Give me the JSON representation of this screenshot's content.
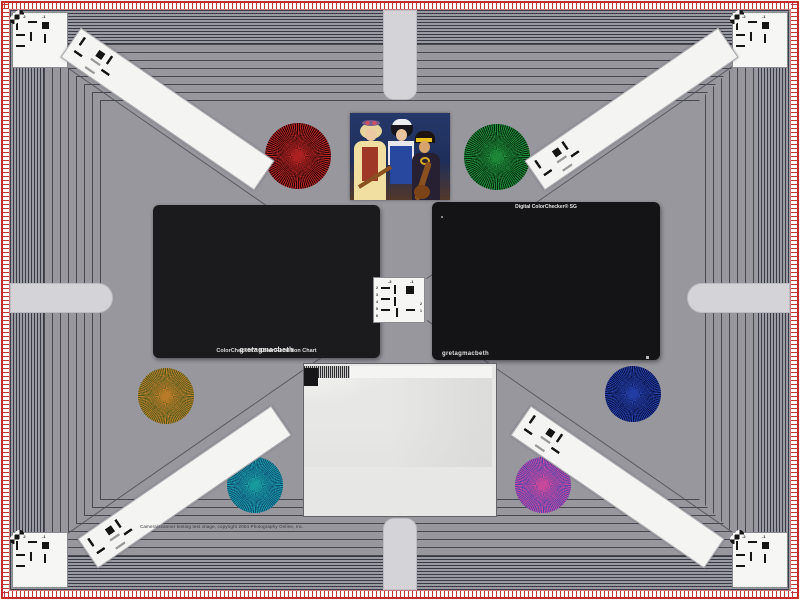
{
  "meta": {
    "background_gray": "#97979d",
    "frame_red": "#c62b2b",
    "tongue_gray": "#d4d4d8",
    "line_color": "#50505a"
  },
  "caption": {
    "text": "Camera/scanner testing test image, copyright 2004 Photography Online, Inc."
  },
  "colorchecker": {
    "brand": "gretagmacbeth",
    "name": "ColorChecker™ Color Rendition Chart",
    "patches": [
      "#7a4b39",
      "#dba08f",
      "#5879a8",
      "#5a6b34",
      "#8f8fc8",
      "#66cfc0",
      "#e1872c",
      "#4b64c0",
      "#da5f72",
      "#6a3d84",
      "#a8bf38",
      "#eab626",
      "#3142bb",
      "#2f9647",
      "#cf3a40",
      "#eecb1e",
      "#dd6ec0",
      "#1a9ed0",
      "#f2f2f0",
      "#d5d5d3",
      "#b2b2b0",
      "#8a8a88",
      "#606060",
      "#2c2c2c"
    ]
  },
  "sg": {
    "title": "Digital ColorChecker® SG",
    "brand": "gretagmacbeth",
    "cols": 14,
    "rows": 10,
    "patches": [
      "#f0f0ee",
      "#9a9a9a",
      "#1e1e1e",
      "#f0f0ee",
      "#9a9a9a",
      "#1e1e1e",
      "#f0f0ee",
      "#9a9a9a",
      "#1e1e1e",
      "#f0f0ee",
      "#9a9a9a",
      "#1e1e1e",
      "#9a9a9a",
      "#f0f0ee",
      "#1e1e1e",
      "#c22858",
      "#4a2470",
      "#b8d0e8",
      "#7a4830",
      "#e89078",
      "#a0c4e0",
      "#3a58a8",
      "#3a4a1a",
      "#6a58b8",
      "#90d8d0",
      "#e8c0a0",
      "#d02030",
      "#e04878",
      "#9a9a9a",
      "#e87828",
      "#207888",
      "#b0b8c0",
      "#4a7828",
      "#3858c0",
      "#e08828",
      "#283878",
      "#784828",
      "#e8d020",
      "#a8c8e8",
      "#906030",
      "#d05868",
      "#1e1e1e",
      "#f0f0ee",
      "#b038c0",
      "#3858d0",
      "#98a8b8",
      "#283890",
      "#28a048",
      "#c03028",
      "#e87820",
      "#e8d020",
      "#e038a0",
      "#18a8d8",
      "#d8c8b8",
      "#e85878",
      "#9a9a9a",
      "#1e1e1e",
      "#48c8c0",
      "#c8d8e8",
      "#f0f0ee",
      "#303030",
      "#282828",
      "#202020",
      "#181818",
      "#303030",
      "#a8d0e8",
      "#687888",
      "#b0b0b0",
      "#d88898",
      "#f0f0ee",
      "#9a9a9a",
      "#18a098",
      "#a0e8d8",
      "#c8e8c0",
      "#282828",
      "#484848",
      "#f0f0ee",
      "#1e1e1e",
      "#e0a020",
      "#f0f0ee",
      "#b8b8b8",
      "#d0d0d0",
      "#e8e020",
      "#1e1e1e",
      "#f0f0ee",
      "#4878c8",
      "#78b8e8",
      "#f0c8a0",
      "#e8a078",
      "#f0b890",
      "#d8a880",
      "#e8b088",
      "#d89878",
      "#909090",
      "#e8c8a8",
      "#e8d838",
      "#f0e020",
      "#9a9a9a",
      "#1e1e1e",
      "#283048",
      "#8858b0",
      "#f0c0a8",
      "#f0a8b0",
      "#e89078",
      "#f0c098",
      "#c89868",
      "#e8b890",
      "#906040",
      "#988028",
      "#b8c828",
      "#403818",
      "#f0f0ee",
      "#9a9a9a",
      "#70c888",
      "#18a078",
      "#086858",
      "#30c8b0",
      "#28a038",
      "#20c030",
      "#186828",
      "#e88828",
      "#909828",
      "#30b818",
      "#784818",
      "#302808",
      "#1e1e1e",
      "#f0f0ee",
      "#9a9a9a",
      "#1e1e1e",
      "#9a9a9a",
      "#f0f0ee",
      "#9a9a9a",
      "#1e1e1e",
      "#f0f0ee",
      "#9a9a9a",
      "#1e1e1e",
      "#f0f0ee",
      "#9a9a9a",
      "#1e1e1e",
      "#f0f0ee"
    ]
  },
  "stars": {
    "red": {
      "colors": [
        "#b42222",
        "#2a0a0a"
      ]
    },
    "green": {
      "colors": [
        "#1f8c3a",
        "#062a10"
      ]
    },
    "orange": {
      "colors": [
        "#c07c28",
        "#4a5a20"
      ]
    },
    "blue": {
      "colors": [
        "#2440aa",
        "#0a1040"
      ]
    },
    "teal": {
      "colors": [
        "#18a0a0",
        "#104878"
      ]
    },
    "magenta": {
      "colors": [
        "#d04898",
        "#4848b0"
      ]
    }
  },
  "usaf": {
    "labels_top": [
      "-2",
      "-1"
    ],
    "labels_left": [
      "2",
      "3",
      "4",
      "5",
      "6"
    ],
    "labels_right": [
      "2",
      "1"
    ]
  },
  "sweep": {
    "bar_widths": [
      12,
      12,
      10,
      9,
      8,
      7,
      6,
      5,
      4,
      4,
      3,
      3,
      2,
      2,
      2,
      2,
      1,
      1,
      1,
      1,
      1,
      1,
      1
    ],
    "bar_colors": [
      "#f4f4f2",
      "#161618"
    ],
    "periods": [
      18,
      12,
      8,
      5,
      3
    ],
    "wedge_steps": [
      "#f4f4f2",
      "#ececea",
      "#e4e4e2",
      "#dcdcda",
      "#d4d4d2",
      "#cccccb",
      "#c4c4c2",
      "#bcbcba",
      "#b4b4b2",
      "#acacaa",
      "#a4a4a2",
      "#9a9a98",
      "#909090",
      "#868684",
      "#7c7c7a",
      "#727270",
      "#686866",
      "#5e5e5c",
      "#545452",
      "#4a4a48"
    ]
  },
  "photo": {
    "palette": {
      "backdrop": "#24366a",
      "skin": "#e8c098",
      "dress_yellow": "#f0dfa0",
      "vest_red": "#a03828",
      "vest_blue": "#2848a0",
      "headband_yellow": "#e8c020",
      "instrument_brown": "#8a5020"
    }
  }
}
